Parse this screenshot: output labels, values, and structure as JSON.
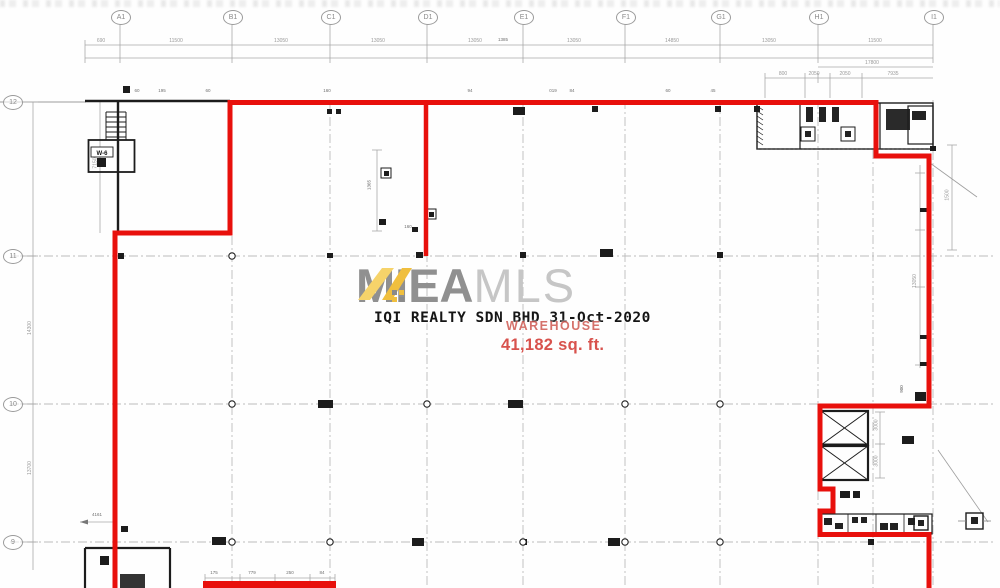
{
  "watermark": {
    "brand_bold": "MIEA",
    "brand_light": "MLS",
    "stamp_line": "IQI REALTY SDN BHD 31-Oct-2020",
    "area_label": "WAREHOUSE",
    "area_value": "41,182 sq. ft."
  },
  "grid": {
    "columns": [
      "A1",
      "B1",
      "C1",
      "D1",
      "E1",
      "F1",
      "G1",
      "H1",
      "I1"
    ],
    "rows": [
      "12",
      "11",
      "10",
      "9"
    ]
  },
  "dims": {
    "top_offset": "690",
    "top": [
      "11500",
      "13050",
      "13050",
      "13050",
      "13050",
      "14850",
      "13050",
      "11500"
    ],
    "top_sub": [
      "17800",
      "800",
      "2050",
      "2050",
      "7935"
    ],
    "left": [
      "7150",
      "14300",
      "13700"
    ],
    "right": [
      "13050",
      "1500",
      "3000",
      "3000"
    ],
    "inner": [
      "1365",
      "160",
      "4161",
      "900",
      "1385"
    ],
    "micro_top": [
      "60",
      "195",
      "60",
      "160",
      "94",
      "019",
      "84",
      "60",
      "45"
    ],
    "bottom": [
      "175",
      "779",
      "250",
      "84"
    ]
  },
  "plan": {
    "unit_tag": "W-6"
  },
  "colors": {
    "boundary_red": "#e8100c",
    "logo_yellow": "#f0bf3e",
    "stamp_red": "#d8524d",
    "brand_gray": "#909090"
  }
}
